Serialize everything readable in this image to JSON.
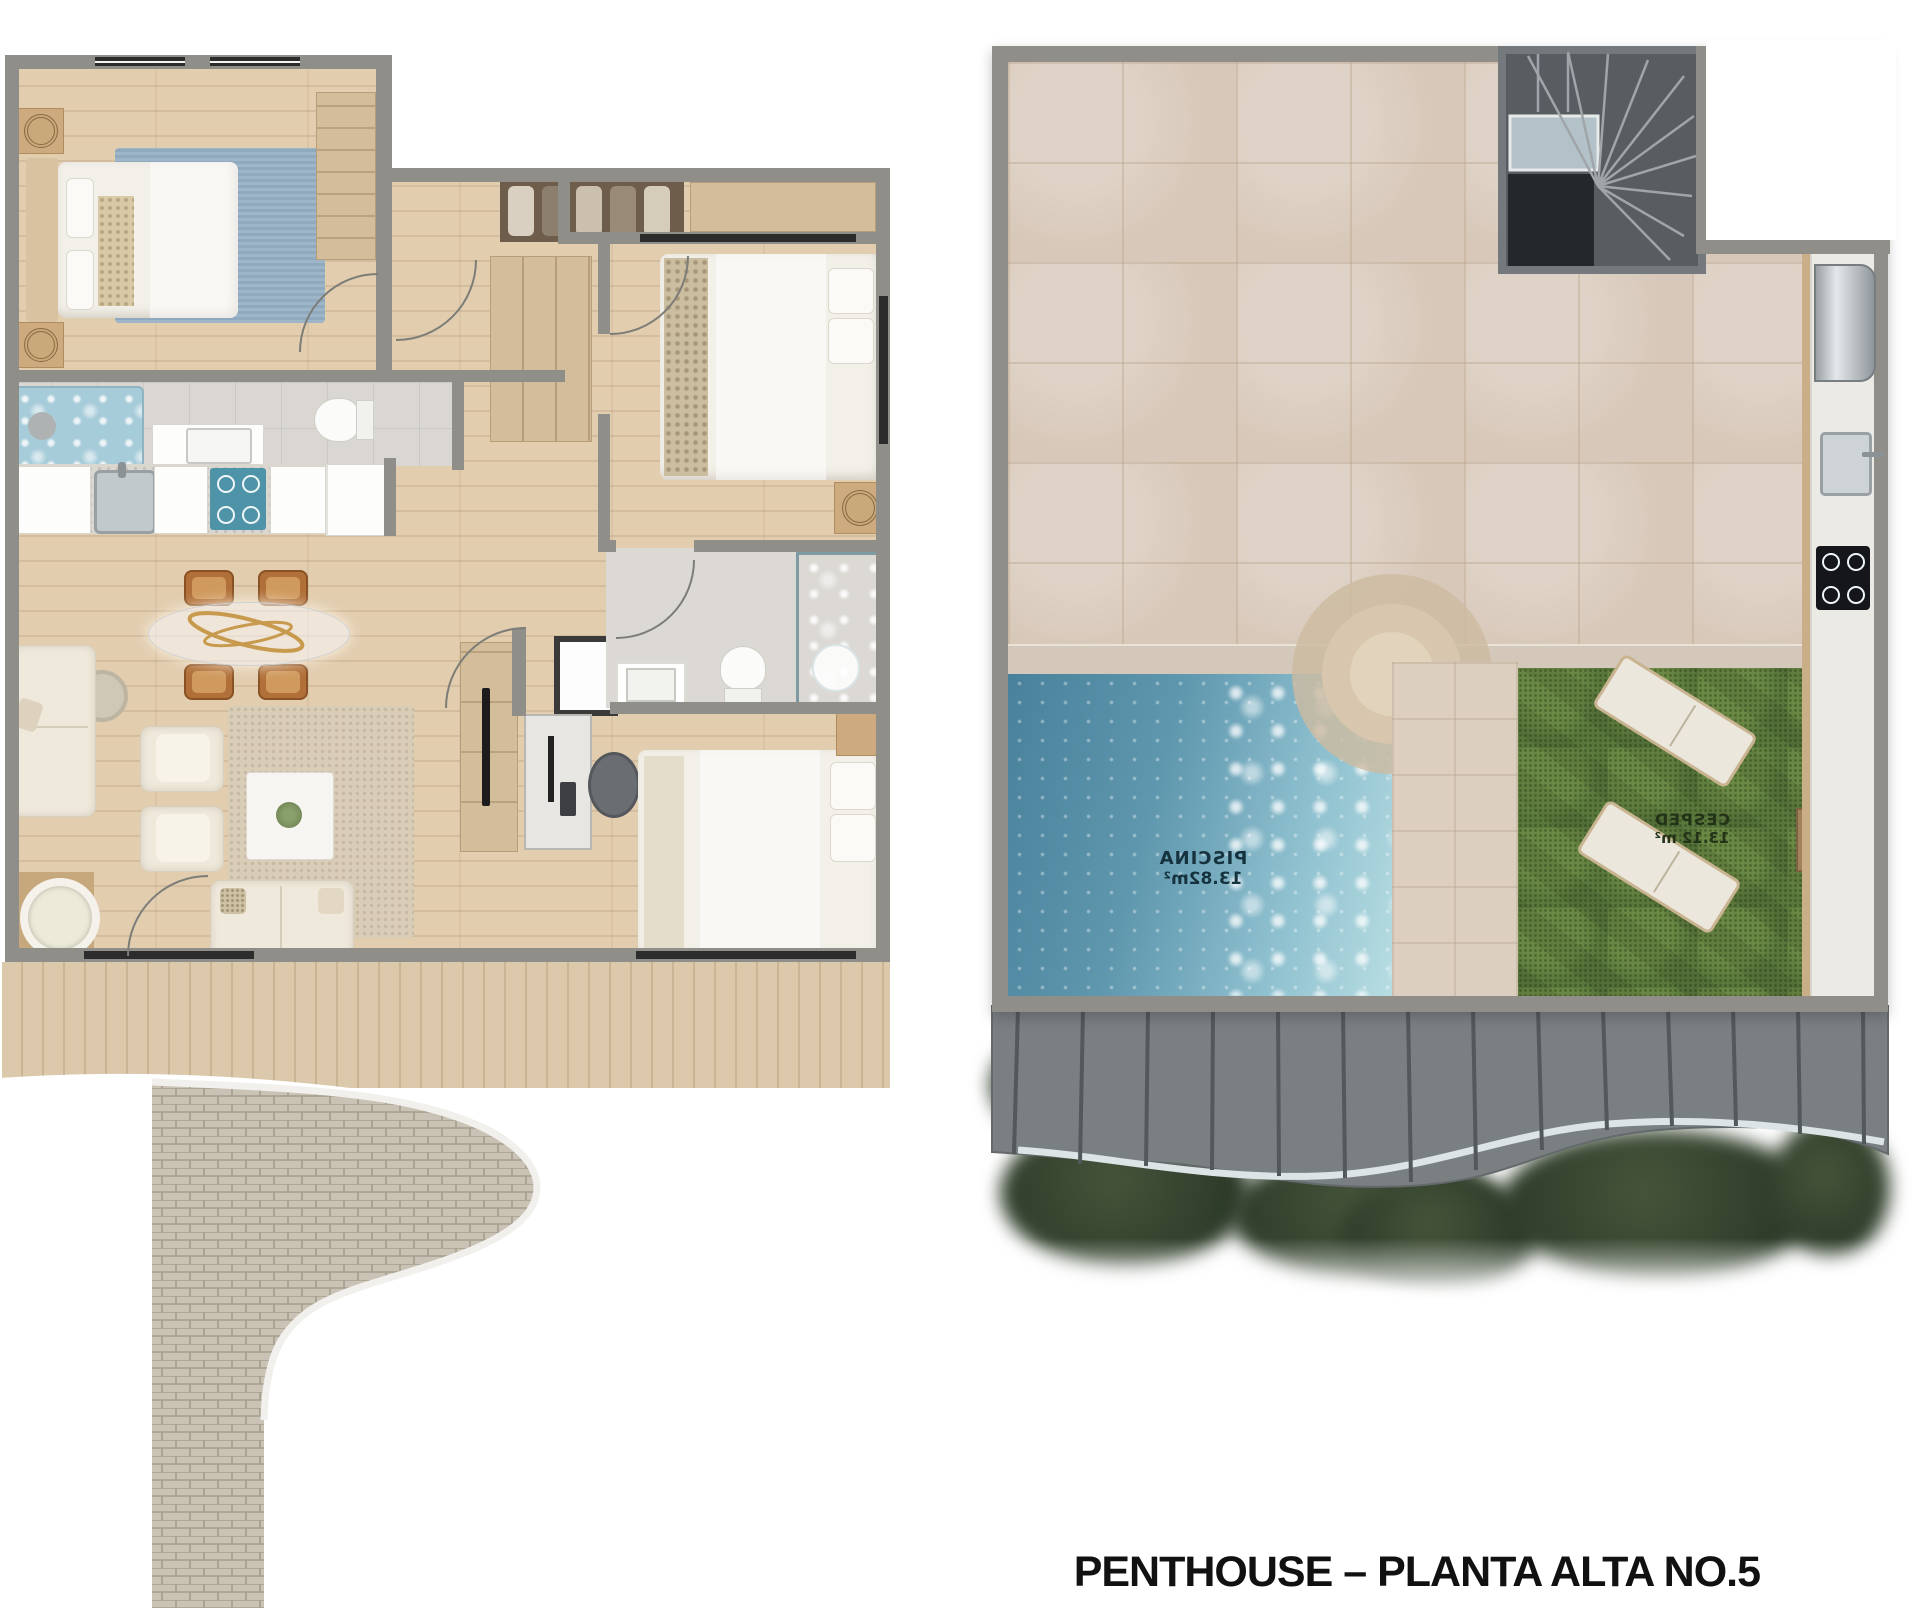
{
  "title": "PENTHOUSE – PLANTA ALTA NO.5",
  "right_plan": {
    "pool_label": {
      "name": "PISCINA",
      "area": "13.82m²"
    },
    "lawn_label": {
      "name": "CESPED",
      "area": "13.12 m²"
    }
  },
  "palette": {
    "wall_gray": "#8f8e89",
    "wood_floor": "#e2cdaf",
    "terrace_tile": "#d7c8b9",
    "pool_water_dark": "#49809b",
    "pool_water_light": "#b7dde2",
    "grass_green": "#5a783c",
    "balcony_slab": "#7a7f82",
    "accent_blue_rug": "#8fa9bf",
    "cooktop_blue": "#4f93a8",
    "chair_amber": "#b1703a"
  }
}
